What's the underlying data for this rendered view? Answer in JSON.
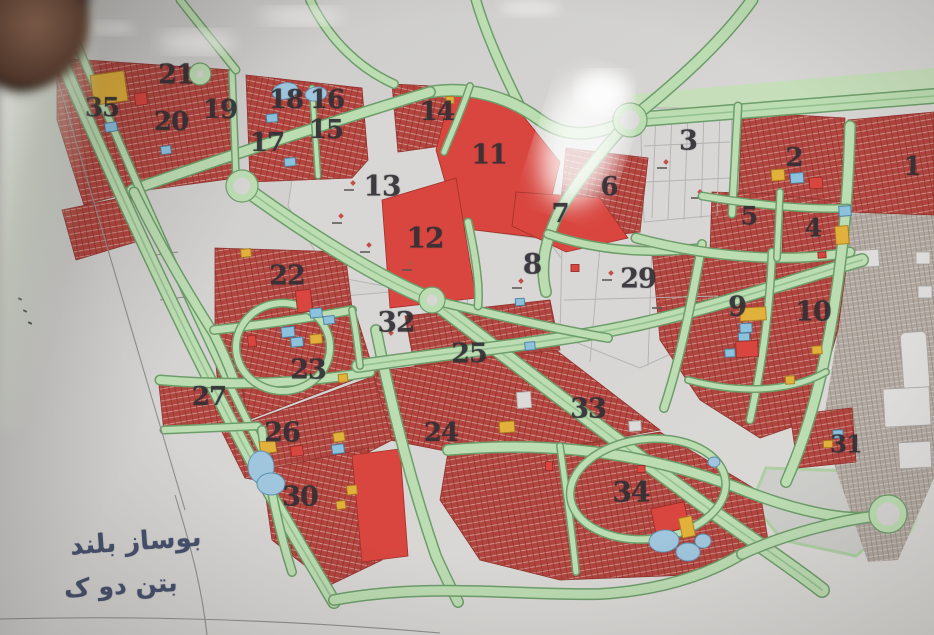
{
  "map": {
    "description": "photographed urban master plan with numbered land-use zones",
    "notes": {
      "line1": "بوساز بلند",
      "line2": "بتن دو ک"
    },
    "colors": {
      "paper": "#d5d4d2",
      "road_green": "#bcdcb2",
      "road_edge": "#6d9d6a",
      "residential_red": "#b1453f",
      "solid_red": "#d8463f",
      "parcel_white": "#d8d7d5",
      "existing_city_grey": "#b0a79f",
      "label_ink": "#312f35",
      "note_ink": "#46516d",
      "blue": "#8cc2dc",
      "yellow": "#e2b13c",
      "red": "#d8463f",
      "white": "#dcdbd9",
      "pond": "#9fc6dd"
    },
    "strokes": {
      "blue": "#4a7fa0",
      "yellow": "#a87f1f",
      "red": "#992e28",
      "white": "#a9a8a6",
      "pond": "#5d8fae"
    },
    "zones": [
      {
        "n": "35",
        "x": 102,
        "y": 108,
        "s": 26
      },
      {
        "n": "21",
        "x": 176,
        "y": 75,
        "s": 27
      },
      {
        "n": "20",
        "x": 171,
        "y": 122,
        "s": 26
      },
      {
        "n": "19",
        "x": 220,
        "y": 110,
        "s": 26
      },
      {
        "n": "18",
        "x": 286,
        "y": 100,
        "s": 26
      },
      {
        "n": "16",
        "x": 327,
        "y": 100,
        "s": 26
      },
      {
        "n": "17",
        "x": 267,
        "y": 143,
        "s": 26
      },
      {
        "n": "15",
        "x": 326,
        "y": 130,
        "s": 26
      },
      {
        "n": "14",
        "x": 437,
        "y": 112,
        "s": 26
      },
      {
        "n": "11",
        "x": 489,
        "y": 155,
        "s": 27
      },
      {
        "n": "13",
        "x": 382,
        "y": 186,
        "s": 28
      },
      {
        "n": "6",
        "x": 609,
        "y": 187,
        "s": 26
      },
      {
        "n": "7",
        "x": 560,
        "y": 214,
        "s": 26
      },
      {
        "n": "3",
        "x": 688,
        "y": 141,
        "s": 27
      },
      {
        "n": "2",
        "x": 794,
        "y": 158,
        "s": 26
      },
      {
        "n": "1",
        "x": 912,
        "y": 167,
        "s": 26
      },
      {
        "n": "5",
        "x": 749,
        "y": 216,
        "s": 25
      },
      {
        "n": "4",
        "x": 813,
        "y": 228,
        "s": 25
      },
      {
        "n": "12",
        "x": 425,
        "y": 238,
        "s": 28
      },
      {
        "n": "8",
        "x": 532,
        "y": 264,
        "s": 28
      },
      {
        "n": "29",
        "x": 638,
        "y": 279,
        "s": 27
      },
      {
        "n": "22",
        "x": 287,
        "y": 276,
        "s": 27
      },
      {
        "n": "9",
        "x": 737,
        "y": 307,
        "s": 27
      },
      {
        "n": "10",
        "x": 813,
        "y": 312,
        "s": 27
      },
      {
        "n": "32",
        "x": 396,
        "y": 322,
        "s": 28
      },
      {
        "n": "25",
        "x": 469,
        "y": 354,
        "s": 27
      },
      {
        "n": "23",
        "x": 308,
        "y": 370,
        "s": 27
      },
      {
        "n": "27",
        "x": 209,
        "y": 397,
        "s": 26
      },
      {
        "n": "33",
        "x": 588,
        "y": 409,
        "s": 27
      },
      {
        "n": "26",
        "x": 282,
        "y": 433,
        "s": 27
      },
      {
        "n": "24",
        "x": 441,
        "y": 433,
        "s": 26
      },
      {
        "n": "30",
        "x": 300,
        "y": 497,
        "s": 27
      },
      {
        "n": "34",
        "x": 631,
        "y": 492,
        "s": 28
      },
      {
        "n": "31",
        "x": 846,
        "y": 444,
        "s": 24
      }
    ],
    "facilities": [
      {
        "x": 109,
        "y": 88,
        "w": 34,
        "h": 30,
        "c": "yellow",
        "r": -8
      },
      {
        "x": 141,
        "y": 99,
        "w": 12,
        "h": 12,
        "c": "red",
        "r": -8
      },
      {
        "x": 111,
        "y": 127,
        "w": 12,
        "h": 9,
        "c": "blue",
        "r": -8
      },
      {
        "x": 166,
        "y": 150,
        "w": 10,
        "h": 8,
        "c": "blue",
        "r": -8
      },
      {
        "x": 272,
        "y": 118,
        "w": 11,
        "h": 8,
        "c": "blue",
        "r": -5
      },
      {
        "x": 290,
        "y": 162,
        "w": 11,
        "h": 8,
        "c": "blue",
        "r": -5
      },
      {
        "x": 450,
        "y": 100,
        "w": 8,
        "h": 7,
        "c": "yellow",
        "r": 0
      },
      {
        "x": 778,
        "y": 175,
        "w": 13,
        "h": 11,
        "c": "yellow",
        "r": -4
      },
      {
        "x": 797,
        "y": 178,
        "w": 13,
        "h": 10,
        "c": "blue",
        "r": -4
      },
      {
        "x": 816,
        "y": 183,
        "w": 13,
        "h": 11,
        "c": "red",
        "r": -4
      },
      {
        "x": 845,
        "y": 211,
        "w": 12,
        "h": 10,
        "c": "blue",
        "r": -4
      },
      {
        "x": 842,
        "y": 235,
        "w": 13,
        "h": 18,
        "c": "yellow",
        "r": -4
      },
      {
        "x": 822,
        "y": 255,
        "w": 8,
        "h": 6,
        "c": "red",
        "r": -4
      },
      {
        "x": 246,
        "y": 253,
        "w": 10,
        "h": 8,
        "c": "yellow",
        "r": -6
      },
      {
        "x": 304,
        "y": 301,
        "w": 15,
        "h": 22,
        "c": "red",
        "r": -6
      },
      {
        "x": 316,
        "y": 313,
        "w": 12,
        "h": 9,
        "c": "blue",
        "r": -6
      },
      {
        "x": 329,
        "y": 320,
        "w": 11,
        "h": 8,
        "c": "blue",
        "r": -6
      },
      {
        "x": 288,
        "y": 332,
        "w": 13,
        "h": 10,
        "c": "blue",
        "r": -6
      },
      {
        "x": 297,
        "y": 342,
        "w": 12,
        "h": 9,
        "c": "blue",
        "r": -6
      },
      {
        "x": 316,
        "y": 339,
        "w": 12,
        "h": 9,
        "c": "yellow",
        "r": -6
      },
      {
        "x": 252,
        "y": 341,
        "w": 8,
        "h": 11,
        "c": "red",
        "r": -6
      },
      {
        "x": 343,
        "y": 378,
        "w": 9,
        "h": 8,
        "c": "yellow",
        "r": -6
      },
      {
        "x": 753,
        "y": 314,
        "w": 26,
        "h": 13,
        "c": "yellow",
        "r": -3
      },
      {
        "x": 746,
        "y": 328,
        "w": 12,
        "h": 9,
        "c": "blue",
        "r": -3
      },
      {
        "x": 744,
        "y": 337,
        "w": 11,
        "h": 8,
        "c": "blue",
        "r": -3
      },
      {
        "x": 747,
        "y": 349,
        "w": 22,
        "h": 16,
        "c": "red",
        "r": -3
      },
      {
        "x": 730,
        "y": 353,
        "w": 10,
        "h": 8,
        "c": "blue",
        "r": -3
      },
      {
        "x": 817,
        "y": 350,
        "w": 10,
        "h": 8,
        "c": "yellow",
        "r": -3
      },
      {
        "x": 790,
        "y": 380,
        "w": 9,
        "h": 8,
        "c": "yellow",
        "r": -3
      },
      {
        "x": 268,
        "y": 447,
        "w": 16,
        "h": 12,
        "c": "yellow",
        "r": -8
      },
      {
        "x": 297,
        "y": 451,
        "w": 12,
        "h": 10,
        "c": "red",
        "r": -8
      },
      {
        "x": 339,
        "y": 437,
        "w": 11,
        "h": 9,
        "c": "yellow",
        "r": -8
      },
      {
        "x": 338,
        "y": 449,
        "w": 12,
        "h": 9,
        "c": "blue",
        "r": -8
      },
      {
        "x": 341,
        "y": 505,
        "w": 9,
        "h": 8,
        "c": "yellow",
        "r": -8
      },
      {
        "x": 352,
        "y": 490,
        "w": 10,
        "h": 9,
        "c": "yellow",
        "r": -6
      },
      {
        "x": 524,
        "y": 400,
        "w": 14,
        "h": 16,
        "c": "white",
        "r": -4
      },
      {
        "x": 507,
        "y": 427,
        "w": 15,
        "h": 11,
        "c": "yellow",
        "r": -4
      },
      {
        "x": 635,
        "y": 426,
        "w": 12,
        "h": 10,
        "c": "white",
        "r": -4
      },
      {
        "x": 549,
        "y": 466,
        "w": 7,
        "h": 9,
        "c": "red",
        "r": 0
      },
      {
        "x": 575,
        "y": 268,
        "w": 8,
        "h": 7,
        "c": "red",
        "r": 0
      },
      {
        "x": 641,
        "y": 469,
        "w": 8,
        "h": 7,
        "c": "red",
        "r": 0
      },
      {
        "x": 838,
        "y": 434,
        "w": 10,
        "h": 8,
        "c": "blue",
        "r": -3
      },
      {
        "x": 828,
        "y": 444,
        "w": 9,
        "h": 7,
        "c": "yellow",
        "r": -3
      },
      {
        "x": 530,
        "y": 346,
        "w": 10,
        "h": 8,
        "c": "blue",
        "r": -4
      },
      {
        "x": 520,
        "y": 302,
        "w": 9,
        "h": 7,
        "c": "blue",
        "r": -4
      },
      {
        "x": 670,
        "y": 518,
        "w": 34,
        "h": 26,
        "c": "red",
        "r": -12
      },
      {
        "x": 687,
        "y": 527,
        "w": 13,
        "h": 20,
        "c": "yellow",
        "r": -12
      }
    ],
    "ponds": [
      {
        "x": 285,
        "y": 91,
        "rx": 13,
        "ry": 8,
        "r": -12
      },
      {
        "x": 316,
        "y": 94,
        "rx": 11,
        "ry": 7,
        "r": -8
      },
      {
        "x": 261,
        "y": 467,
        "rx": 13,
        "ry": 16,
        "r": 0
      },
      {
        "x": 271,
        "y": 484,
        "rx": 14,
        "ry": 11,
        "r": 0
      },
      {
        "x": 664,
        "y": 541,
        "rx": 15,
        "ry": 11,
        "r": -6
      },
      {
        "x": 688,
        "y": 552,
        "rx": 12,
        "ry": 9,
        "r": 0
      },
      {
        "x": 703,
        "y": 541,
        "rx": 8,
        "ry": 7,
        "r": 0
      },
      {
        "x": 714,
        "y": 462,
        "rx": 6,
        "ry": 5,
        "r": 0
      }
    ]
  }
}
